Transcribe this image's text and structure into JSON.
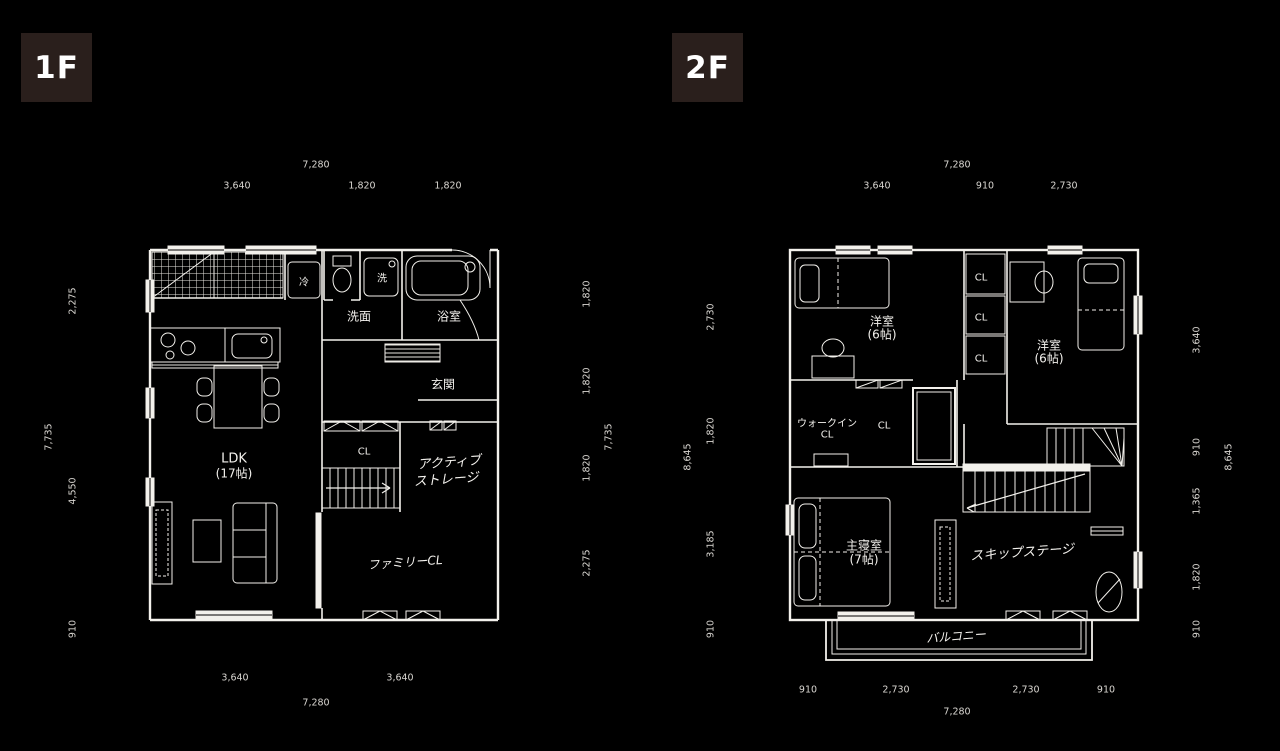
{
  "floor1": {
    "badge": "1F",
    "dims": {
      "top_total": "7,280",
      "top": [
        "3,640",
        "1,820",
        "1,820"
      ],
      "left_total": "7,735",
      "left": [
        "2,275",
        "4,550",
        "910"
      ],
      "right": [
        "1,820",
        "1,820",
        "1,820",
        "2,275"
      ],
      "right_total": "7,735",
      "bottom": [
        "3,640",
        "3,640"
      ],
      "bottom_total": "7,280"
    },
    "rooms": {
      "fridge": "冷",
      "washer": "洗",
      "washroom": "洗面",
      "bath": "浴室",
      "entrance": "玄関",
      "closet": "CL",
      "ldk": "LDK",
      "ldk_size": "(17帖)",
      "active_storage_1": "アクティブ",
      "active_storage_2": "ストレージ",
      "family_closet": "ファミリーCL"
    }
  },
  "floor2": {
    "badge": "2F",
    "dims": {
      "top_total": "7,280",
      "top": [
        "3,640",
        "910",
        "2,730"
      ],
      "left_total": "8,645",
      "left": [
        "2,730",
        "1,820",
        "3,185",
        "910"
      ],
      "right": [
        "3,640",
        "910",
        "1,365",
        "1,820",
        "910"
      ],
      "right_total": "8,645",
      "bottom": [
        "910",
        "2,730",
        "2,730",
        "910"
      ],
      "bottom_total": "7,280"
    },
    "rooms": {
      "bedroom_left": "洋室",
      "bedroom_left_size": "(6帖)",
      "cl_1": "CL",
      "cl_2": "CL",
      "cl_3": "CL",
      "bedroom_right": "洋室",
      "bedroom_right_size": "(6帖)",
      "wic_line1": "ウォークイン",
      "wic_line2": "CL",
      "wic_cl": "CL",
      "master": "主寝室",
      "master_size": "(7帖)",
      "skip_stage": "スキップステージ",
      "balcony": "バルコニー"
    }
  }
}
